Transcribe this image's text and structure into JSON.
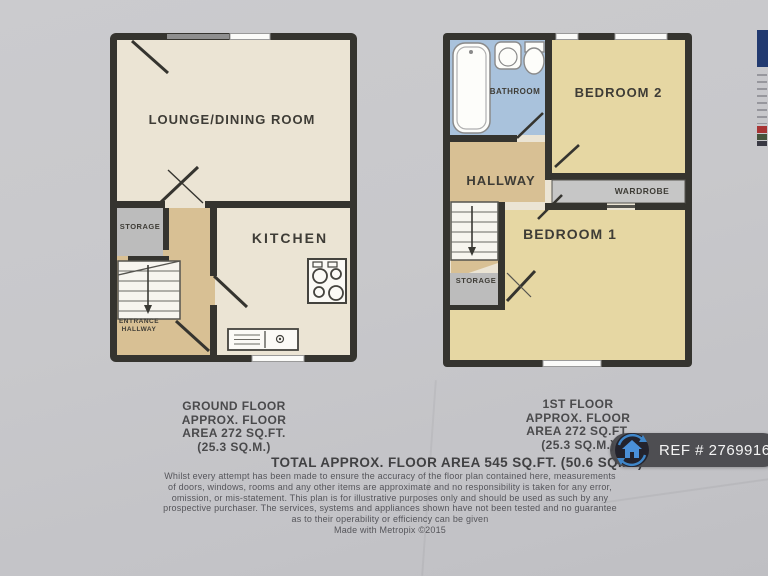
{
  "ground_floor": {
    "lounge_label": "LOUNGE/DINING ROOM",
    "storage_label": "STORAGE",
    "kitchen_label": "KITCHEN",
    "entrance_line1": "ENTRANCE",
    "entrance_line2": "HALLWAY",
    "caption": [
      "GROUND FLOOR",
      "APPROX. FLOOR",
      "AREA 272 SQ.FT.",
      "(25.3 SQ.M.)"
    ]
  },
  "first_floor": {
    "bathroom_label": "BATHROOM",
    "bedroom2_label": "BEDROOM 2",
    "hallway_label": "HALLWAY",
    "wardrobe_label": "WARDROBE",
    "storage_label": "STORAGE",
    "bedroom1_label": "BEDROOM 1",
    "caption": [
      "1ST FLOOR",
      "APPROX. FLOOR",
      "AREA 272 SQ.FT.",
      "(25.3 SQ.M.)"
    ]
  },
  "footer": {
    "total": "TOTAL APPROX. FLOOR AREA 545 SQ.FT. (50.6 SQ.M.)",
    "disclaimer": [
      "Whilst every attempt has been made to ensure the accuracy of the floor plan contained here, measurements",
      "of doors, windows, rooms and any other items are approximate and no responsibility is taken for any error,",
      "omission, or mis-statement. This plan is for illustrative purposes only and should be used as such by any",
      "prospective purchaser. The services, systems and appliances shown have not been tested and no guarantee",
      "as to their operability or efficiency can be given"
    ],
    "credit": "Made with Metropix ©2015"
  },
  "ref_badge": {
    "label": "REF # 2769916"
  },
  "colors": {
    "wall": "#35342f",
    "plan_cream": "#ebe4d4",
    "hall_tan": "#d8c094",
    "bedroom_yellow": "#e6d7a3",
    "bathroom_blue": "#a9c2dc",
    "storage_gray": "#bcbcbc",
    "badge_bg": "#48484c",
    "icon_blue": "#4a90d9"
  }
}
